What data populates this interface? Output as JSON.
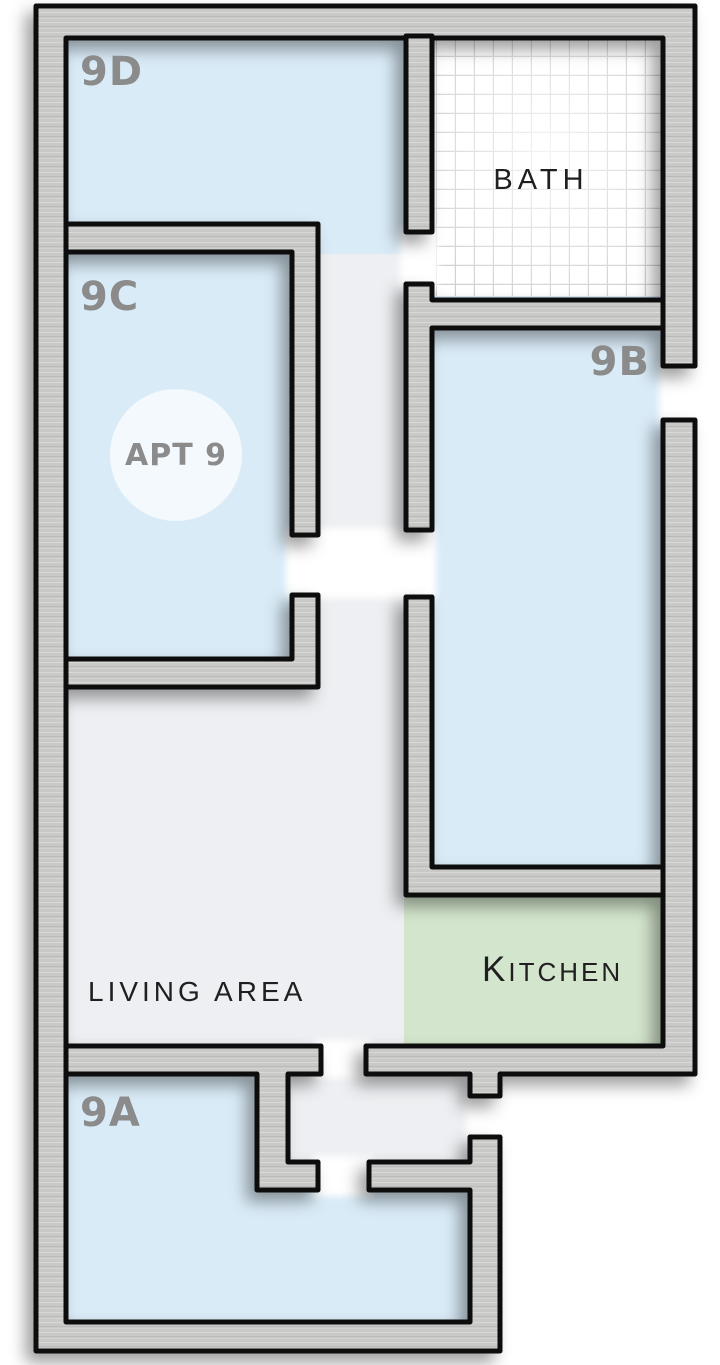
{
  "badge": {
    "label": "APT 9"
  },
  "rooms": {
    "d": {
      "label": "9D"
    },
    "c": {
      "label": "9C"
    },
    "b": {
      "label": "9B"
    },
    "a": {
      "label": "9A"
    },
    "bath": {
      "label": "BATH"
    },
    "kitchen": {
      "label": "KITCHEN",
      "initial": "K",
      "rest": "ITCHEN"
    },
    "living": {
      "label": "LIVING AREA"
    }
  },
  "colors": {
    "room_blue": "#d9ebf7",
    "corridor_gray": "#edeff2",
    "kitchen_green": "#d3e5cc",
    "bath_white": "#ffffff",
    "tile_grid": "#c9c9c9",
    "wall_fill": "#c9c9c7",
    "wall_outline": "#0f0f0f",
    "room_label": "#8b8b8b",
    "text_dark": "#1f1f1f",
    "badge_fill": "#f3f9fd"
  }
}
